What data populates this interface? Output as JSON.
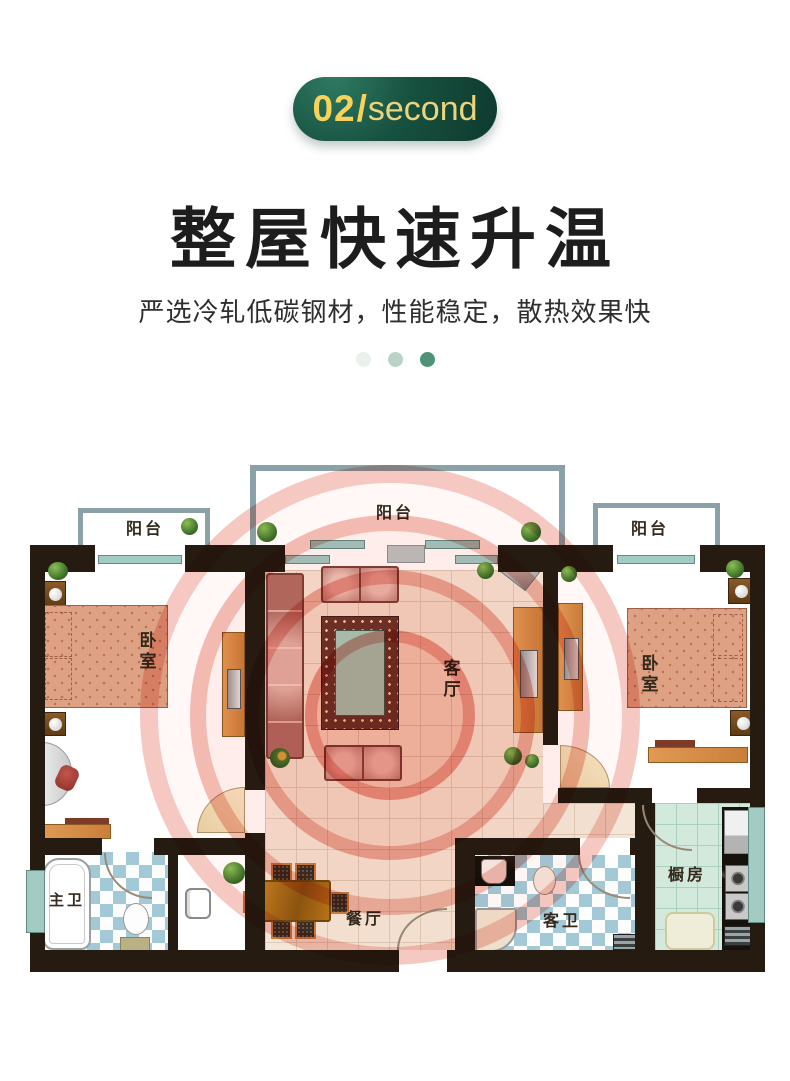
{
  "badge": {
    "number": "02",
    "slash": "/",
    "word": "second"
  },
  "title": "整屋快速升温",
  "subtitle": "严选冷轧低碳钢材，性能稳定，散热效果快",
  "pagination_dots": [
    "#e9f1ed",
    "#b9d4c7",
    "#4f9278"
  ],
  "colors": {
    "badge_bg_dark": "#0e3a2f",
    "badge_bg_light": "#2f7a63",
    "badge_text": "#f7d35a",
    "heading_text": "#1d1d1d",
    "heat_ring": "#df584a",
    "heat_fill": "#f7ac9f",
    "wall": "#261b11",
    "floor_tile": "#f3e6d6",
    "kitchen_tile": "#d3e9dc",
    "bath_tile": "#a3c8d6",
    "bed": "#dfa183",
    "sofa": "#b26e64",
    "rug_border": "#6d342b",
    "rug_table": "#a9d8ca",
    "cabinet": "#dc9a55",
    "window": "#a2cbc4"
  },
  "floorplan": {
    "balcony_left": "阳台",
    "balcony_middle": "阳台",
    "balcony_right": "阳台",
    "bedroom_left": "卧室",
    "bedroom_right": "卧室",
    "living_room": "客厅",
    "dining_room": "餐厅",
    "master_bath": "主卫",
    "guest_bath": "客卫",
    "kitchen": "橱房"
  }
}
